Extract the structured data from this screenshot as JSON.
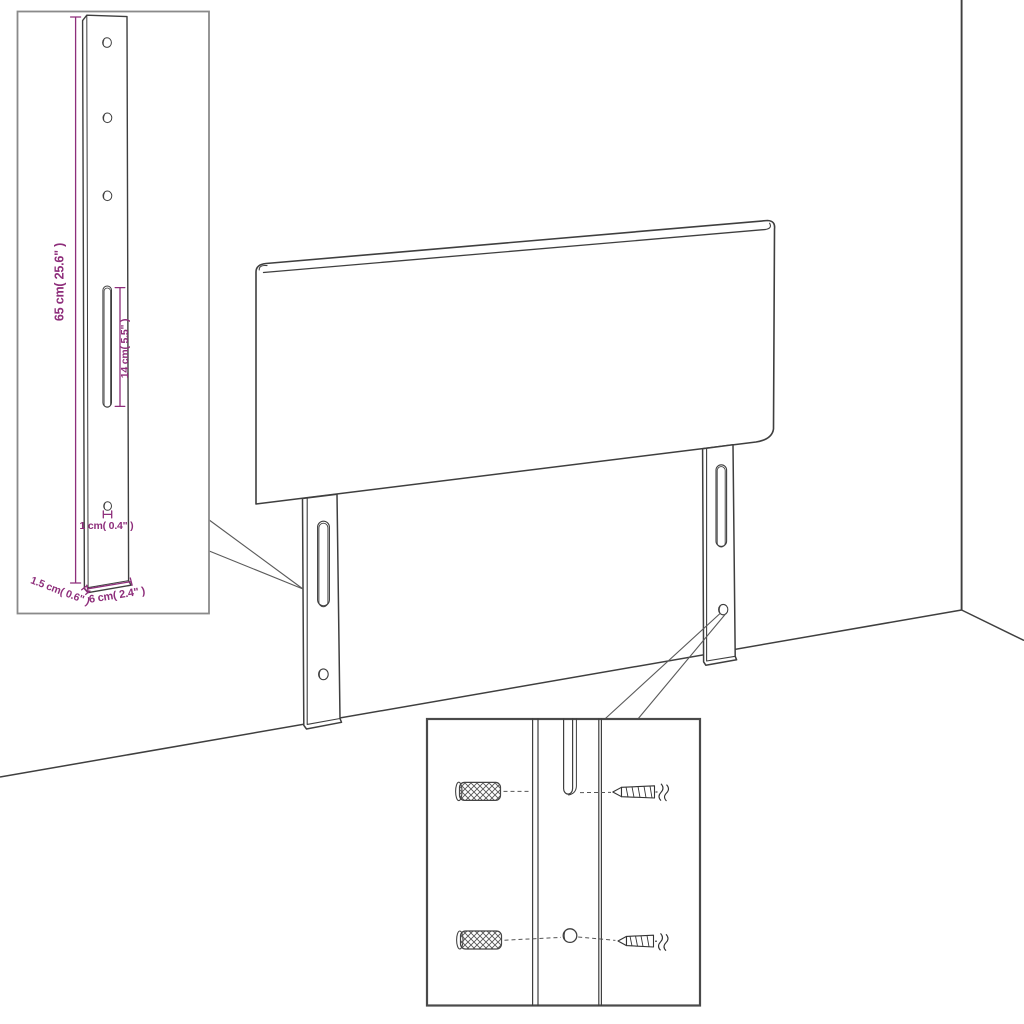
{
  "diagram": {
    "type": "headboard-assembly-dimension-diagram",
    "colors": {
      "background": "#ffffff",
      "drawing_line": "#3f3f3f",
      "dimension": "#8e2e7b",
      "inset_border": "#8a8a8a",
      "detail_border": "#4a4a4a",
      "callout_line": "#5a5a5a"
    },
    "dims": {
      "leg_height": "65 cm( 25.6\" )",
      "slot_length": "14 cm( 5.5\" )",
      "hole_diameter": "1 cm( 0.4\" )",
      "leg_thickness": "1.5 cm( 0.6\" )",
      "leg_width": "6 cm( 2.4\" )"
    }
  }
}
